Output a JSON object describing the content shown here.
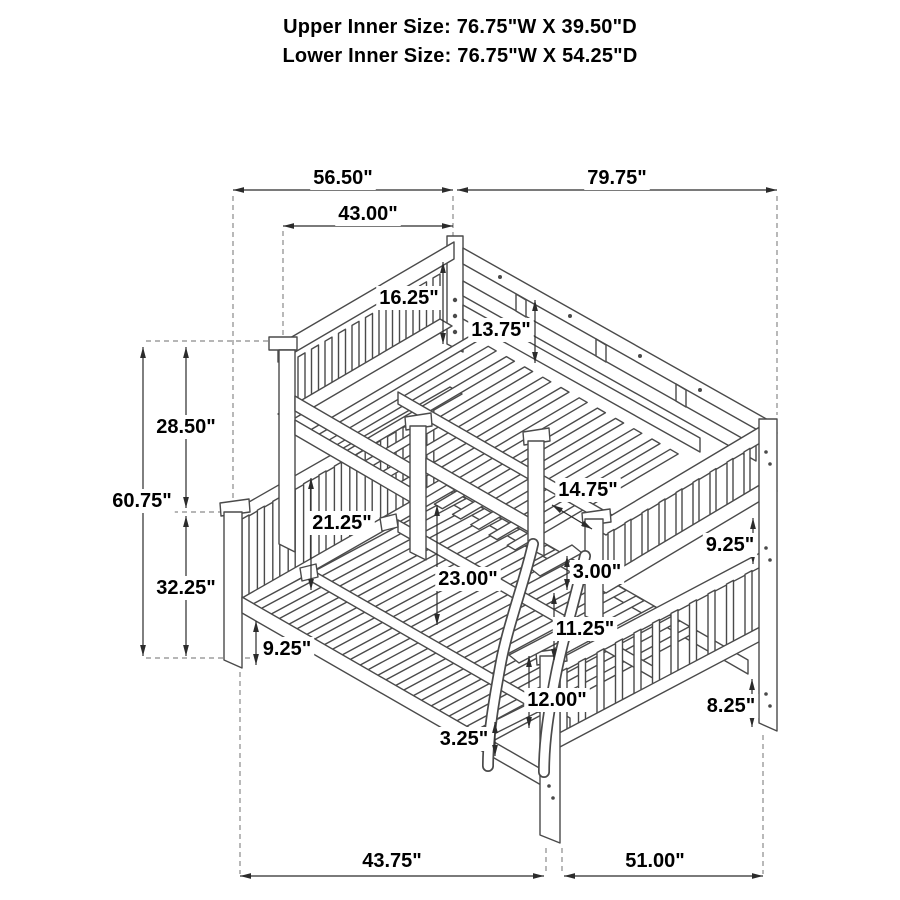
{
  "title": {
    "line1": "Upper Inner Size: 76.75\"W X 39.50\"D",
    "line2": "Lower Inner Size: 76.75\"W X 54.25\"D"
  },
  "diagram": {
    "subject": "twin-over-full bunk bed isometric line drawing with ladder",
    "colors": {
      "background": "#ffffff",
      "line_art": "#4a4a4a",
      "dimension_lines": "#2b2b2b",
      "text": "#000000",
      "extension_dashes": "#8a8a8a"
    },
    "dimensions": [
      {
        "label": "56.50\"",
        "x1": 233,
        "y1": 190,
        "x2": 453,
        "y2": 190,
        "lx": 343,
        "ly": 177
      },
      {
        "label": "79.75\"",
        "x1": 457,
        "y1": 190,
        "x2": 777,
        "y2": 190,
        "lx": 617,
        "ly": 177
      },
      {
        "label": "43.00\"",
        "x1": 283,
        "y1": 226,
        "x2": 453,
        "y2": 226,
        "lx": 368,
        "ly": 213
      },
      {
        "label": "16.25\"",
        "x1": 443,
        "y1": 262,
        "x2": 443,
        "y2": 344,
        "lx": 409,
        "ly": 297
      },
      {
        "label": "13.75\"",
        "x1": 535,
        "y1": 300,
        "x2": 535,
        "y2": 363,
        "lx": 501,
        "ly": 329
      },
      {
        "label": "28.50\"",
        "x1": 186,
        "y1": 347,
        "x2": 186,
        "y2": 508,
        "lx": 186,
        "ly": 426
      },
      {
        "label": "60.75\"",
        "x1": 143,
        "y1": 347,
        "x2": 143,
        "y2": 656,
        "lx": 142,
        "ly": 500
      },
      {
        "label": "32.25\"",
        "x1": 186,
        "y1": 516,
        "x2": 186,
        "y2": 656,
        "lx": 186,
        "ly": 587
      },
      {
        "label": "21.25\"",
        "x1": 311,
        "y1": 478,
        "x2": 311,
        "y2": 590,
        "lx": 342,
        "ly": 522
      },
      {
        "label": "23.00\"",
        "x1": 437,
        "y1": 505,
        "x2": 437,
        "y2": 625,
        "lx": 468,
        "ly": 578
      },
      {
        "label": "14.75\"",
        "x1": 552,
        "y1": 505,
        "x2": 592,
        "y2": 529,
        "lx": 588,
        "ly": 489
      },
      {
        "label": "3.00\"",
        "x1": 567,
        "y1": 556,
        "x2": 567,
        "y2": 590,
        "lx": 597,
        "ly": 571
      },
      {
        "label": "11.25\"",
        "x1": 554,
        "y1": 593,
        "x2": 554,
        "y2": 660,
        "lx": 585,
        "ly": 628
      },
      {
        "label": "9.25\"",
        "x1": 753,
        "y1": 518,
        "x2": 753,
        "y2": 564,
        "lx": 730,
        "ly": 544
      },
      {
        "label": "9.25\"",
        "x1": 256,
        "y1": 621,
        "x2": 256,
        "y2": 665,
        "lx": 287,
        "ly": 648
      },
      {
        "label": "12.00\"",
        "x1": 529,
        "y1": 656,
        "x2": 529,
        "y2": 728,
        "lx": 557,
        "ly": 699
      },
      {
        "label": "3.25\"",
        "x1": 495,
        "y1": 722,
        "x2": 495,
        "y2": 756,
        "lx": 464,
        "ly": 738
      },
      {
        "label": "8.25\"",
        "x1": 752,
        "y1": 679,
        "x2": 752,
        "y2": 727,
        "lx": 731,
        "ly": 705
      },
      {
        "label": "43.75\"",
        "x1": 240,
        "y1": 876,
        "x2": 544,
        "y2": 876,
        "lx": 392,
        "ly": 860
      },
      {
        "label": "51.00\"",
        "x1": 564,
        "y1": 876,
        "x2": 763,
        "y2": 876,
        "lx": 655,
        "ly": 860
      }
    ]
  }
}
